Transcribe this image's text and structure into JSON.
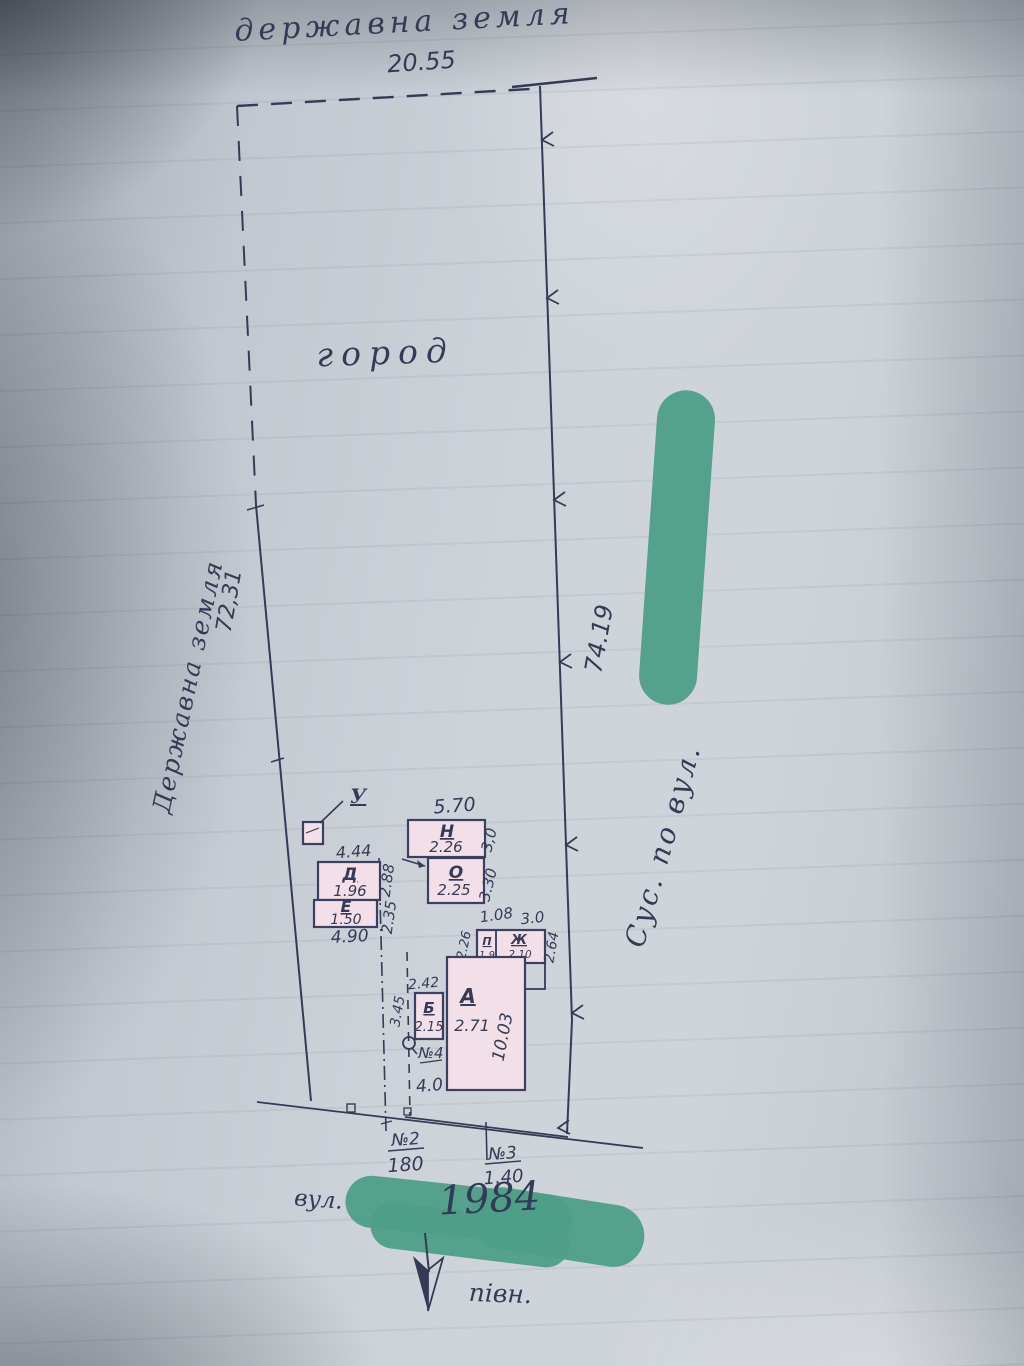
{
  "colors": {
    "ink": "#353b56",
    "building_fill": "#f3dfe7",
    "redaction_green": "#4d9f88",
    "paper": "#ccd1d8"
  },
  "top_boundary": {
    "label": "державна земля",
    "length": "20.55"
  },
  "left_boundary": {
    "label": "Державна земля",
    "length": "72,31"
  },
  "right_boundary": {
    "length": "74.19",
    "neighbor_label": "Сус. по вул."
  },
  "garden": {
    "label": "город"
  },
  "buildings": {
    "toilet": {
      "letter": "У"
    },
    "d": {
      "letter": "Д",
      "value": "1.96",
      "width_top": "4.44",
      "depth": "2.88"
    },
    "e": {
      "letter": "Е",
      "value": "1.50",
      "width_bottom": "4.90",
      "depth": "2.35"
    },
    "n": {
      "letter": "Н",
      "value": "2.26",
      "width_top": "5.70",
      "depth": "3,0"
    },
    "o": {
      "letter": "О",
      "value": "2.25",
      "depth": "3.30"
    },
    "shed": {
      "letter_left": "П",
      "value_left": "1.9",
      "letter_right": "Ж",
      "value_right": "2.10",
      "width_left": "1.08",
      "width_right": "3.0",
      "depth_left": "2.26",
      "depth_right": "2.64"
    },
    "b": {
      "letter": "Б",
      "value": "2.15",
      "width_top": "2.42",
      "depth": "3.45"
    },
    "a": {
      "letter": "А",
      "value": "2.71",
      "depth": "10.03"
    }
  },
  "gates": {
    "n2": {
      "id": "№2",
      "width": "180"
    },
    "n3": {
      "id": "№3",
      "width": "1.40"
    },
    "n4": {
      "id": "№4",
      "width": "4.0"
    }
  },
  "street": {
    "label": "вул.",
    "number": "1984"
  },
  "compass": {
    "label": "півн."
  }
}
